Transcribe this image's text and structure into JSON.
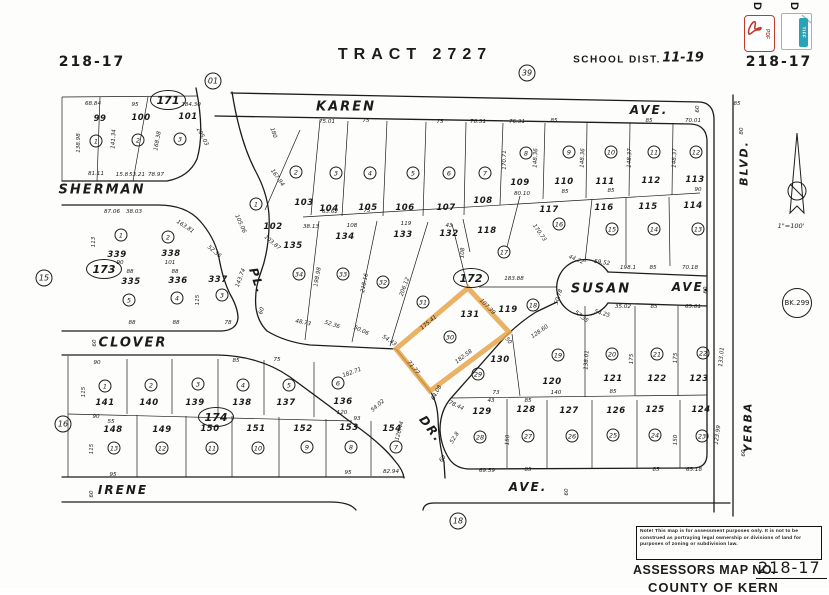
{
  "header": {
    "sheet_no_left": "218-17",
    "sheet_no_right": "218-17",
    "tract_title": "TRACT 2727",
    "school_label": "SCHOOL DIST.",
    "school_value": "11-19"
  },
  "toolbar": {
    "items": [
      {
        "label": "D",
        "type": "PDF"
      },
      {
        "label": "D",
        "type": "TIFF"
      }
    ]
  },
  "compass": {
    "scale": "1\"=100'"
  },
  "footer": {
    "note": "Note! This map is for assessment purposes only. It is not to be construed as portraying legal ownership or divisions of land for purposes of zoning or subdivision law.",
    "assessors_label": "ASSESSORS MAP NO.",
    "map_no": "218-17",
    "county": "COUNTY OF KERN"
  },
  "highlight": {
    "color": "#e5a549",
    "parcel": "131",
    "points": "468,288 509,332 430,391 396,349"
  },
  "refs": [
    {
      "t": "01",
      "x": 213,
      "y": 81,
      "k": "refc"
    },
    {
      "t": "39",
      "x": 527,
      "y": 73,
      "k": "refc"
    },
    {
      "t": "15",
      "x": 44,
      "y": 278,
      "k": "refc"
    },
    {
      "t": "16",
      "x": 63,
      "y": 424,
      "k": "refc"
    },
    {
      "t": "18",
      "x": 458,
      "y": 521,
      "k": "refc"
    },
    {
      "t": "171",
      "x": 168,
      "y": 100,
      "k": "oval"
    },
    {
      "t": "173",
      "x": 104,
      "y": 269,
      "k": "oval"
    },
    {
      "t": "174",
      "x": 216,
      "y": 417,
      "k": "oval"
    },
    {
      "t": "172",
      "x": 471,
      "y": 278,
      "k": "oval"
    },
    {
      "t": "BK.299",
      "x": 797,
      "y": 303,
      "k": "bk"
    }
  ],
  "streets": [
    {
      "t": "SHERMAN",
      "x": 102,
      "y": 190,
      "s": 13
    },
    {
      "t": "KAREN",
      "x": 346,
      "y": 107,
      "s": 13
    },
    {
      "t": "AVE.",
      "x": 649,
      "y": 110,
      "s": 12
    },
    {
      "t": "SUSAN",
      "x": 601,
      "y": 289,
      "s": 13
    },
    {
      "t": "AVE.",
      "x": 691,
      "y": 287,
      "s": 12
    },
    {
      "t": "CLOVER",
      "x": 133,
      "y": 343,
      "s": 13
    },
    {
      "t": "PL.",
      "x": 257,
      "y": 281,
      "s": 12,
      "r": 72
    },
    {
      "t": "DR.",
      "x": 431,
      "y": 429,
      "s": 12,
      "r": 52
    },
    {
      "t": "IRENE",
      "x": 123,
      "y": 490,
      "s": 12
    },
    {
      "t": "AVE.",
      "x": 528,
      "y": 487,
      "s": 12
    },
    {
      "t": "BLVD.",
      "x": 744,
      "y": 163,
      "s": 11,
      "r": -90
    },
    {
      "t": "YERBA",
      "x": 748,
      "y": 427,
      "s": 11,
      "r": -90
    }
  ],
  "lots": [
    {
      "n": "99",
      "x": 100,
      "y": 119,
      "c": "1",
      "cx": 96,
      "cy": 141
    },
    {
      "n": "100",
      "x": 141,
      "y": 118,
      "c": "2",
      "cx": 138,
      "cy": 140
    },
    {
      "n": "101",
      "x": 188,
      "y": 117,
      "c": "3",
      "cx": 180,
      "cy": 139
    },
    {
      "n": "102",
      "x": 273,
      "y": 227,
      "c": "1",
      "cx": 256,
      "cy": 204
    },
    {
      "n": "103",
      "x": 304,
      "y": 203,
      "c": "2",
      "cx": 296,
      "cy": 172
    },
    {
      "n": "104",
      "x": 329,
      "y": 209,
      "c": "3",
      "cx": 336,
      "cy": 173
    },
    {
      "n": "105",
      "x": 368,
      "y": 208,
      "c": "4",
      "cx": 370,
      "cy": 173
    },
    {
      "n": "106",
      "x": 405,
      "y": 208,
      "c": "5",
      "cx": 413,
      "cy": 173
    },
    {
      "n": "107",
      "x": 446,
      "y": 208,
      "c": "6",
      "cx": 449,
      "cy": 173
    },
    {
      "n": "108",
      "x": 483,
      "y": 201,
      "c": "7",
      "cx": 485,
      "cy": 173
    },
    {
      "n": "109",
      "x": 520,
      "y": 183,
      "c": "8",
      "cx": 526,
      "cy": 153
    },
    {
      "n": "110",
      "x": 564,
      "y": 182,
      "c": "9",
      "cx": 569,
      "cy": 152
    },
    {
      "n": "111",
      "x": 605,
      "y": 182,
      "c": "10",
      "cx": 611,
      "cy": 152
    },
    {
      "n": "112",
      "x": 651,
      "y": 181,
      "c": "11",
      "cx": 654,
      "cy": 152
    },
    {
      "n": "113",
      "x": 695,
      "y": 180,
      "c": "12",
      "cx": 696,
      "cy": 152
    },
    {
      "n": "117",
      "x": 549,
      "y": 210,
      "c": "16",
      "cx": 559,
      "cy": 224
    },
    {
      "n": "116",
      "x": 604,
      "y": 208,
      "c": "15",
      "cx": 612,
      "cy": 229
    },
    {
      "n": "115",
      "x": 648,
      "y": 207,
      "c": "14",
      "cx": 654,
      "cy": 229
    },
    {
      "n": "114",
      "x": 693,
      "y": 206,
      "c": "13",
      "cx": 698,
      "cy": 229
    },
    {
      "n": "118",
      "x": 487,
      "y": 231,
      "c": "17",
      "cx": 504,
      "cy": 252
    },
    {
      "n": "119",
      "x": 508,
      "y": 310,
      "c": "18",
      "cx": 533,
      "cy": 305
    },
    {
      "n": "135",
      "x": 293,
      "y": 246,
      "c": "34",
      "cx": 299,
      "cy": 274
    },
    {
      "n": "134",
      "x": 345,
      "y": 237,
      "c": "33",
      "cx": 343,
      "cy": 274
    },
    {
      "n": "133",
      "x": 403,
      "y": 235,
      "c": "32",
      "cx": 383,
      "cy": 282
    },
    {
      "n": "132",
      "x": 449,
      "y": 234,
      "c": "31",
      "cx": 423,
      "cy": 302
    },
    {
      "n": "131",
      "x": 470,
      "y": 315,
      "c": "30",
      "cx": 450,
      "cy": 337
    },
    {
      "n": "339",
      "x": 117,
      "y": 255,
      "c": "1",
      "cx": 121,
      "cy": 235
    },
    {
      "n": "338",
      "x": 171,
      "y": 254,
      "c": "2",
      "cx": 168,
      "cy": 237
    },
    {
      "n": "335",
      "x": 131,
      "y": 282,
      "c": "5",
      "cx": 129,
      "cy": 300
    },
    {
      "n": "336",
      "x": 178,
      "y": 281,
      "c": "4",
      "cx": 177,
      "cy": 298
    },
    {
      "n": "337",
      "x": 218,
      "y": 280,
      "c": "3",
      "cx": 222,
      "cy": 295
    },
    {
      "n": "141",
      "x": 105,
      "y": 403,
      "c": "1",
      "cx": 105,
      "cy": 386
    },
    {
      "n": "140",
      "x": 149,
      "y": 403,
      "c": "2",
      "cx": 151,
      "cy": 385
    },
    {
      "n": "139",
      "x": 195,
      "y": 403,
      "c": "3",
      "cx": 198,
      "cy": 384
    },
    {
      "n": "138",
      "x": 242,
      "y": 403,
      "c": "4",
      "cx": 243,
      "cy": 385
    },
    {
      "n": "137",
      "x": 286,
      "y": 403,
      "c": "5",
      "cx": 289,
      "cy": 385
    },
    {
      "n": "136",
      "x": 343,
      "y": 402,
      "c": "6",
      "cx": 338,
      "cy": 383
    },
    {
      "n": "148",
      "x": 113,
      "y": 430,
      "c": "13",
      "cx": 114,
      "cy": 448
    },
    {
      "n": "149",
      "x": 162,
      "y": 430,
      "c": "12",
      "cx": 162,
      "cy": 448
    },
    {
      "n": "150",
      "x": 210,
      "y": 429,
      "c": "11",
      "cx": 212,
      "cy": 448
    },
    {
      "n": "151",
      "x": 256,
      "y": 429,
      "c": "10",
      "cx": 258,
      "cy": 448
    },
    {
      "n": "152",
      "x": 303,
      "y": 429,
      "c": "9",
      "cx": 307,
      "cy": 447
    },
    {
      "n": "153",
      "x": 349,
      "y": 428,
      "c": "8",
      "cx": 351,
      "cy": 447
    },
    {
      "n": "154",
      "x": 392,
      "y": 429,
      "c": "7",
      "cx": 396,
      "cy": 447
    },
    {
      "n": "130",
      "x": 500,
      "y": 360,
      "c": "29",
      "cx": 478,
      "cy": 374
    },
    {
      "n": "129",
      "x": 482,
      "y": 412,
      "c": "28",
      "cx": 480,
      "cy": 437
    },
    {
      "n": "120",
      "x": 552,
      "y": 382,
      "c": "19",
      "cx": 558,
      "cy": 355
    },
    {
      "n": "121",
      "x": 613,
      "y": 379,
      "c": "20",
      "cx": 612,
      "cy": 354
    },
    {
      "n": "122",
      "x": 657,
      "y": 379,
      "c": "21",
      "cx": 657,
      "cy": 354
    },
    {
      "n": "123",
      "x": 699,
      "y": 379,
      "c": "22",
      "cx": 703,
      "cy": 353
    },
    {
      "n": "128",
      "x": 526,
      "y": 410,
      "c": "27",
      "cx": 528,
      "cy": 436
    },
    {
      "n": "127",
      "x": 569,
      "y": 411,
      "c": "26",
      "cx": 572,
      "cy": 436
    },
    {
      "n": "126",
      "x": 616,
      "y": 411,
      "c": "25",
      "cx": 613,
      "cy": 435
    },
    {
      "n": "125",
      "x": 655,
      "y": 410,
      "c": "24",
      "cx": 655,
      "cy": 435
    },
    {
      "n": "124",
      "x": 701,
      "y": 410,
      "c": "23",
      "cx": 702,
      "cy": 436
    }
  ],
  "dims": [
    {
      "t": "68.84",
      "x": 93,
      "y": 104
    },
    {
      "t": "95",
      "x": 135,
      "y": 105
    },
    {
      "t": "184.30",
      "x": 191,
      "y": 105
    },
    {
      "t": "138.98",
      "x": 79,
      "y": 143,
      "r": -90
    },
    {
      "t": "141.34",
      "x": 114,
      "y": 139,
      "r": -87
    },
    {
      "t": "168.38",
      "x": 158,
      "y": 141,
      "r": -80
    },
    {
      "t": "205.03",
      "x": 202,
      "y": 137,
      "r": 62
    },
    {
      "t": "81.11",
      "x": 96,
      "y": 174
    },
    {
      "t": "15.8",
      "x": 122,
      "y": 175
    },
    {
      "t": "53.21",
      "x": 137,
      "y": 175
    },
    {
      "t": "78.97",
      "x": 156,
      "y": 175
    },
    {
      "t": "180",
      "x": 273,
      "y": 133,
      "r": 70
    },
    {
      "t": "167.94",
      "x": 277,
      "y": 178,
      "r": 55
    },
    {
      "t": "75.01",
      "x": 327,
      "y": 122
    },
    {
      "t": "75",
      "x": 366,
      "y": 121
    },
    {
      "t": "75",
      "x": 440,
      "y": 122
    },
    {
      "t": "76.31",
      "x": 478,
      "y": 122
    },
    {
      "t": "76.31",
      "x": 517,
      "y": 122
    },
    {
      "t": "85",
      "x": 554,
      "y": 121
    },
    {
      "t": "85",
      "x": 649,
      "y": 121
    },
    {
      "t": "70.01",
      "x": 693,
      "y": 121
    },
    {
      "t": "85",
      "x": 737,
      "y": 104
    },
    {
      "t": "63.62",
      "x": 330,
      "y": 212
    },
    {
      "t": "75",
      "x": 367,
      "y": 211
    },
    {
      "t": "38.13",
      "x": 311,
      "y": 227
    },
    {
      "t": "108",
      "x": 352,
      "y": 226
    },
    {
      "t": "119",
      "x": 406,
      "y": 224
    },
    {
      "t": "43",
      "x": 449,
      "y": 226
    },
    {
      "t": "105.06",
      "x": 240,
      "y": 224,
      "r": 65
    },
    {
      "t": "103.87",
      "x": 272,
      "y": 243,
      "r": 40
    },
    {
      "t": "170.71",
      "x": 505,
      "y": 160,
      "r": -90
    },
    {
      "t": "148.36",
      "x": 536,
      "y": 158,
      "r": -88
    },
    {
      "t": "148.36",
      "x": 583,
      "y": 158,
      "r": -88
    },
    {
      "t": "148.37",
      "x": 630,
      "y": 158,
      "r": -88
    },
    {
      "t": "148.37",
      "x": 675,
      "y": 158,
      "r": -88
    },
    {
      "t": "80.10",
      "x": 522,
      "y": 194
    },
    {
      "t": "85",
      "x": 565,
      "y": 192
    },
    {
      "t": "85",
      "x": 611,
      "y": 191
    },
    {
      "t": "90",
      "x": 698,
      "y": 190
    },
    {
      "t": "87.06",
      "x": 112,
      "y": 212
    },
    {
      "t": "38.03",
      "x": 134,
      "y": 212
    },
    {
      "t": "163.81",
      "x": 185,
      "y": 227,
      "r": 33
    },
    {
      "t": "52.36",
      "x": 214,
      "y": 252,
      "r": 40
    },
    {
      "t": "113",
      "x": 94,
      "y": 242,
      "r": -90
    },
    {
      "t": "90",
      "x": 120,
      "y": 263
    },
    {
      "t": "101",
      "x": 170,
      "y": 263
    },
    {
      "t": "88",
      "x": 130,
      "y": 272
    },
    {
      "t": "88",
      "x": 175,
      "y": 272
    },
    {
      "t": "115",
      "x": 198,
      "y": 300,
      "r": -90
    },
    {
      "t": "143.74",
      "x": 241,
      "y": 278,
      "r": -70
    },
    {
      "t": "88",
      "x": 132,
      "y": 323
    },
    {
      "t": "88",
      "x": 176,
      "y": 323
    },
    {
      "t": "78",
      "x": 228,
      "y": 323
    },
    {
      "t": "198.98",
      "x": 318,
      "y": 277,
      "r": -80
    },
    {
      "t": "218.16",
      "x": 365,
      "y": 283,
      "r": -78
    },
    {
      "t": "206.12",
      "x": 405,
      "y": 287,
      "r": -70
    },
    {
      "t": "108",
      "x": 463,
      "y": 253,
      "r": -85
    },
    {
      "t": "48.73",
      "x": 303,
      "y": 323,
      "r": 12
    },
    {
      "t": "52.36",
      "x": 332,
      "y": 325,
      "r": 18
    },
    {
      "t": "50.06",
      "x": 361,
      "y": 331,
      "r": 25
    },
    {
      "t": "54.43",
      "x": 389,
      "y": 341,
      "r": 33
    },
    {
      "t": "175.41",
      "x": 429,
      "y": 323,
      "r": -40
    },
    {
      "t": "107.39",
      "x": 487,
      "y": 307,
      "r": 45
    },
    {
      "t": "182.58",
      "x": 464,
      "y": 357,
      "r": -37
    },
    {
      "t": "71.77",
      "x": 413,
      "y": 368,
      "r": 50
    },
    {
      "t": "50",
      "x": 508,
      "y": 341,
      "r": 50
    },
    {
      "t": "183.88",
      "x": 514,
      "y": 279
    },
    {
      "t": "170.73",
      "x": 539,
      "y": 233,
      "r": 55
    },
    {
      "t": "44.22",
      "x": 576,
      "y": 260,
      "r": 22
    },
    {
      "t": "59.52",
      "x": 602,
      "y": 263,
      "r": 8
    },
    {
      "t": "198.1",
      "x": 628,
      "y": 268
    },
    {
      "t": "85",
      "x": 653,
      "y": 268
    },
    {
      "t": "70.18",
      "x": 690,
      "y": 268
    },
    {
      "t": "50.78",
      "x": 559,
      "y": 297,
      "r": -72
    },
    {
      "t": "57.35",
      "x": 581,
      "y": 317,
      "r": 38
    },
    {
      "t": "54.25",
      "x": 602,
      "y": 314,
      "r": 15
    },
    {
      "t": "35.02",
      "x": 623,
      "y": 307
    },
    {
      "t": "85",
      "x": 654,
      "y": 307
    },
    {
      "t": "65.01",
      "x": 693,
      "y": 307
    },
    {
      "t": "128.60",
      "x": 540,
      "y": 332,
      "r": -35
    },
    {
      "t": "90",
      "x": 97,
      "y": 363
    },
    {
      "t": "85",
      "x": 236,
      "y": 361
    },
    {
      "t": "75",
      "x": 277,
      "y": 360
    },
    {
      "t": "115",
      "x": 84,
      "y": 392,
      "r": -90
    },
    {
      "t": "90",
      "x": 96,
      "y": 417
    },
    {
      "t": "55",
      "x": 111,
      "y": 422
    },
    {
      "t": "115",
      "x": 92,
      "y": 449,
      "r": -90
    },
    {
      "t": "95",
      "x": 113,
      "y": 475
    },
    {
      "t": "182.71",
      "x": 352,
      "y": 373,
      "r": -20
    },
    {
      "t": "120",
      "x": 342,
      "y": 413
    },
    {
      "t": "93",
      "x": 357,
      "y": 419
    },
    {
      "t": "54.02",
      "x": 378,
      "y": 406,
      "r": -42
    },
    {
      "t": "126.44",
      "x": 400,
      "y": 431,
      "r": -75
    },
    {
      "t": "64.08",
      "x": 437,
      "y": 393,
      "r": -62
    },
    {
      "t": "95",
      "x": 348,
      "y": 473
    },
    {
      "t": "82.94",
      "x": 391,
      "y": 472
    },
    {
      "t": "78.44",
      "x": 456,
      "y": 406,
      "r": 25
    },
    {
      "t": "73",
      "x": 496,
      "y": 393
    },
    {
      "t": "43",
      "x": 491,
      "y": 401
    },
    {
      "t": "85",
      "x": 528,
      "y": 401
    },
    {
      "t": "140",
      "x": 556,
      "y": 393
    },
    {
      "t": "85",
      "x": 613,
      "y": 392
    },
    {
      "t": "138.01",
      "x": 587,
      "y": 360,
      "r": -87
    },
    {
      "t": "175",
      "x": 632,
      "y": 359,
      "r": -88
    },
    {
      "t": "175",
      "x": 676,
      "y": 358,
      "r": -88
    },
    {
      "t": "133.01",
      "x": 722,
      "y": 357,
      "r": -85
    },
    {
      "t": "150",
      "x": 508,
      "y": 440,
      "r": -87
    },
    {
      "t": "150",
      "x": 676,
      "y": 440,
      "r": -88
    },
    {
      "t": "123.99",
      "x": 718,
      "y": 435,
      "r": -82
    },
    {
      "t": "52.8",
      "x": 455,
      "y": 438,
      "r": -58
    },
    {
      "t": "69.59",
      "x": 487,
      "y": 471
    },
    {
      "t": "85",
      "x": 528,
      "y": 470
    },
    {
      "t": "85",
      "x": 656,
      "y": 470
    },
    {
      "t": "65.18",
      "x": 694,
      "y": 470
    },
    {
      "t": "80",
      "x": 742,
      "y": 131,
      "r": -90
    },
    {
      "t": "60",
      "x": 698,
      "y": 109,
      "r": -90
    },
    {
      "t": "60",
      "x": 706,
      "y": 290,
      "r": -90
    },
    {
      "t": "60",
      "x": 262,
      "y": 311,
      "r": -72
    },
    {
      "t": "60",
      "x": 95,
      "y": 343,
      "r": -90
    },
    {
      "t": "60",
      "x": 443,
      "y": 459,
      "r": -52
    },
    {
      "t": "60",
      "x": 92,
      "y": 494,
      "r": -90
    },
    {
      "t": "60",
      "x": 567,
      "y": 492,
      "r": -90
    },
    {
      "t": "60",
      "x": 744,
      "y": 453,
      "r": -90
    }
  ]
}
